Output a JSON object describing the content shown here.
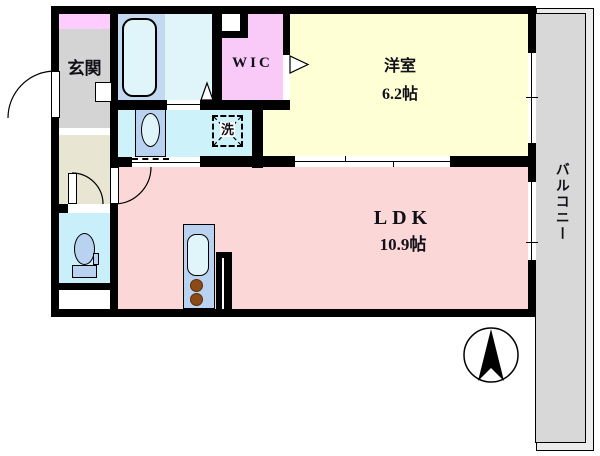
{
  "floorplan": {
    "rooms": {
      "genkan": {
        "label": "玄関"
      },
      "wic": {
        "label": "WIC"
      },
      "yoshitsu": {
        "label": "洋室",
        "size": "6.2帖"
      },
      "ldk": {
        "label": "LDK",
        "size": "10.9帖"
      },
      "laundry": {
        "label": "洗"
      },
      "balcony": {
        "label": "バルコニー"
      }
    },
    "colors": {
      "wall": "#000000",
      "genkan_floor": "#d4d4d4",
      "genkan_cabinet": "#ffccff",
      "hall_floor": "#e8e5d2",
      "bathroom_surround": "#c2d9f1",
      "bathroom_floor": "#dff5fa",
      "washroom_floor": "#cdf2fa",
      "toilet_floor": "#c9effa",
      "wic_floor": "#f9c9f7",
      "yoshitsu_floor": "#ffffd6",
      "ldk_floor": "#fcd7d7",
      "fixture_blue": "#b9d2f0",
      "burner_brown": "#8b4a17",
      "balcony_floor": "#d8d8d8"
    }
  }
}
